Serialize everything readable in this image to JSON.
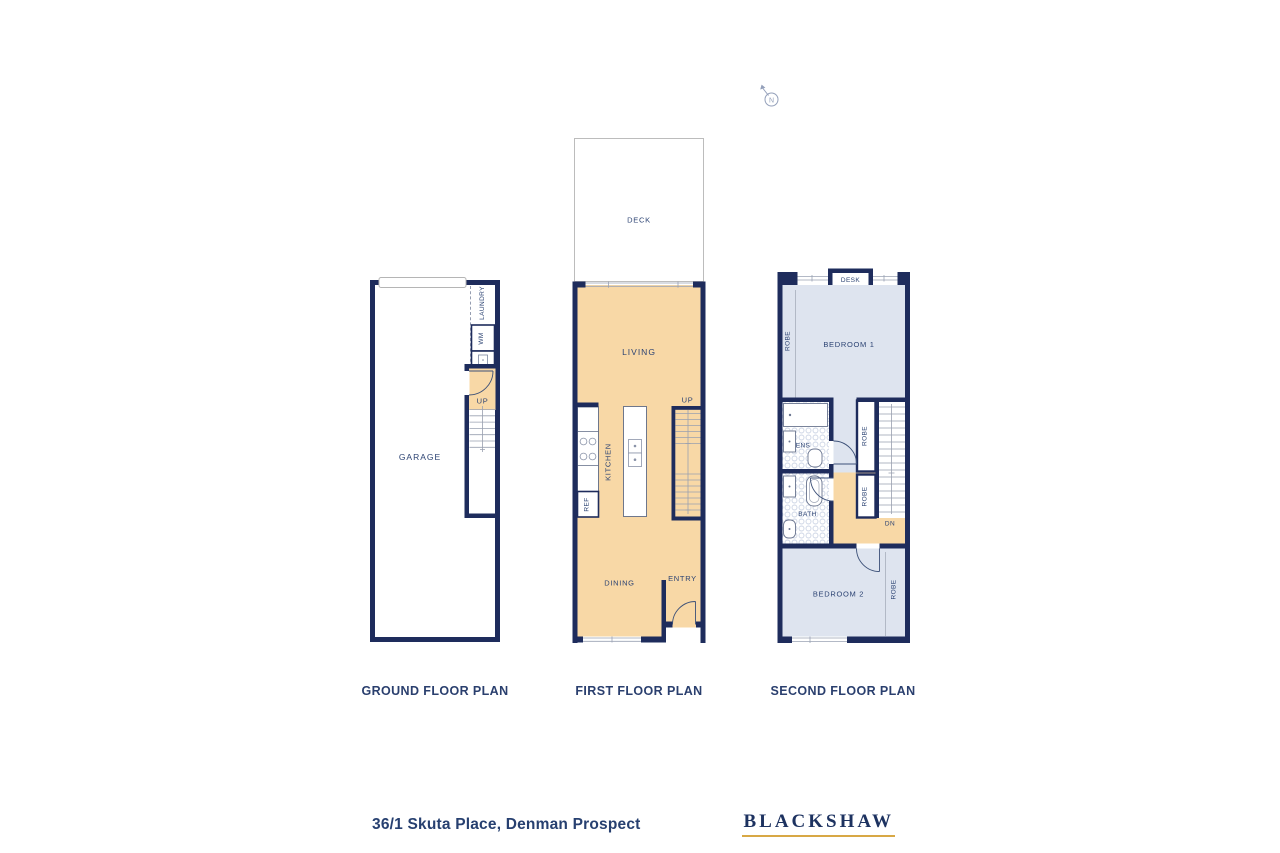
{
  "colors": {
    "wall": "#1e2c5c",
    "label_text": "#2c4373",
    "floor_warm": "#f8d8a6",
    "floor_cool": "#dee4ef",
    "logo_underline": "#d8a845"
  },
  "compass": {
    "label": "N"
  },
  "plans": {
    "ground": {
      "title": "GROUND FLOOR PLAN",
      "labels": {
        "garage": "GARAGE",
        "laundry": "LAUNDRY",
        "wm": "WM",
        "up": "UP"
      }
    },
    "first": {
      "title": "FIRST FLOOR PLAN",
      "labels": {
        "deck": "DECK",
        "living": "LIVING",
        "kitchen": "KITCHEN",
        "ref": "REF",
        "up": "UP",
        "dining": "DINING",
        "entry": "ENTRY"
      }
    },
    "second": {
      "title": "SECOND FLOOR PLAN",
      "labels": {
        "desk": "DESK",
        "bedroom1": "BEDROOM 1",
        "robe_left": "ROBE",
        "ens": "ENS",
        "robe_hall_upper": "ROBE",
        "robe_hall_lower": "ROBE",
        "bath": "BATH",
        "dn": "DN",
        "bedroom2": "BEDROOM 2",
        "robe_bed2": "ROBE"
      }
    }
  },
  "footer": {
    "address": "36/1 Skuta Place, Denman Prospect",
    "brand": "BLACKSHAW"
  }
}
